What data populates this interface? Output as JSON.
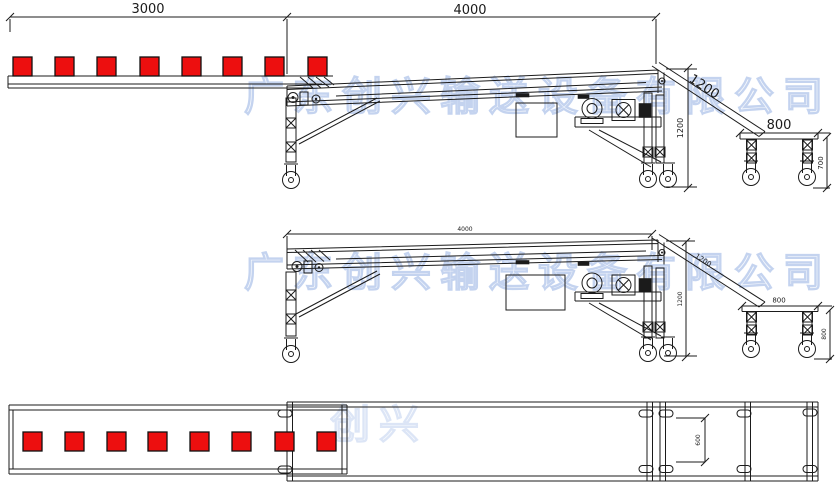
{
  "title": "Conveyor system technical drawing (three views)",
  "colors": {
    "line": "#1b1b1b",
    "product": "#ed0f0f",
    "product_border": "#111111",
    "watermark": "#9db7e6",
    "background": "#ffffff"
  },
  "watermark": {
    "text": "广东创兴输送设备有限公司",
    "fragment": "创兴"
  },
  "views": {
    "side_with_products": {
      "name": "side elevation with products",
      "dim_feed_length": "3000",
      "dim_main_length": "4000",
      "dim_incline_length": "1200",
      "dim_frame_height": "1200",
      "dim_table_length": "800",
      "dim_table_height": "700",
      "product_count": 8
    },
    "side": {
      "name": "side elevation",
      "dim_main_length": "4000",
      "dim_incline_length": "1200",
      "dim_frame_height": "1200",
      "dim_table_length": "800",
      "dim_table_height": "800"
    },
    "plan": {
      "name": "plan view",
      "dim_belt_width": "600",
      "product_count": 8
    }
  }
}
